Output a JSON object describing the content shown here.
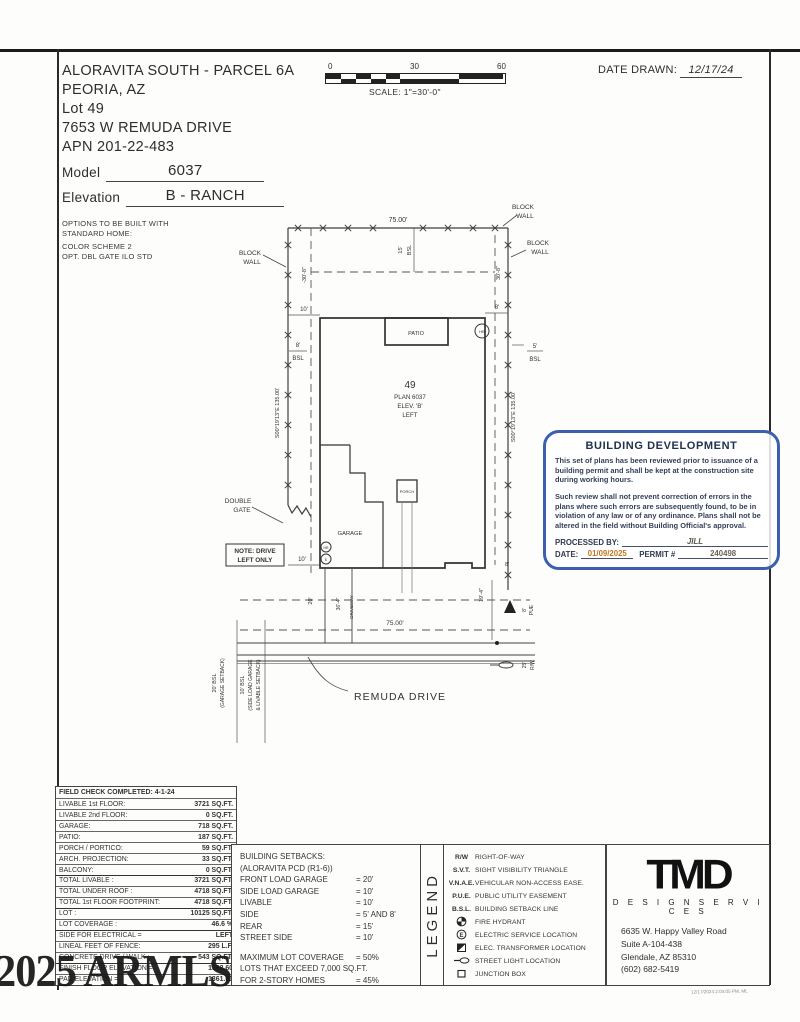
{
  "header": {
    "project": "ALORAVITA SOUTH - PARCEL 6A",
    "city": "PEORIA, AZ",
    "lot": "Lot  49",
    "address": "7653 W REMUDA DRIVE",
    "apn": "APN 201-22-483",
    "model_label": "Model",
    "model_value": "6037",
    "elevation_label": "Elevation",
    "elevation_value": "B - RANCH",
    "options_line1": "OPTIONS TO BE BUILT WITH",
    "options_line2": "STANDARD HOME:",
    "options_line3": "COLOR SCHEME 2",
    "options_line4": "OPT. DBL GATE ILO STD"
  },
  "scale_bar": {
    "tick0": "0",
    "tick30": "30",
    "tick60": "60",
    "scale_text": "SCALE:  1\"=30'-0\""
  },
  "date_drawn": {
    "label": "DATE DRAWN:",
    "value": "12/17/24"
  },
  "plan": {
    "labels": {
      "dim75_top": "75.00'",
      "dim75_bottom": "75.00'",
      "n15": "15'",
      "bsl": "BSL",
      "n30_8_neg": "-30'-8\"",
      "n30_8": "30'-8\"",
      "block": "BLOCK",
      "wall": "WALL",
      "n10": "10'",
      "n8": "8'",
      "n5": "5'",
      "patio": "PATIO",
      "hb": "HB",
      "e": "E",
      "lot49": "49",
      "plan_no": "PLAN 6037",
      "elev": "ELEV. 'B'",
      "left": "LEFT",
      "bearing": "S00°19'13\"E  135.00'",
      "double_word": "DOUBLE",
      "gate_word": "GATE",
      "garage": "GARAGE",
      "porch": "PORCH",
      "note1": "NOTE: DRIVE",
      "note2": "LEFT ONLY",
      "n20": "20'",
      "n36_4": "36'-4\"",
      "driveway": "DRIVEWAY",
      "n19_4": "19'-4\"",
      "pue": "PUE",
      "n25": "25'",
      "rw": "R/W",
      "street_name": "REMUDA DRIVE",
      "sb20a": "20' BSL",
      "sb20b": "(GARAGE SETBACK)",
      "sb10a": "10' BSL",
      "sb10b": "(SIDE LOAD GARAGE",
      "sb10c": "& LIVABLE SETBACK)"
    }
  },
  "stamp": {
    "title": "BUILDING DEVELOPMENT",
    "p1": "This set of plans has been reviewed prior to issuance of a building permit and shall be kept at the construction site during working hours.",
    "p2": "Such review shall not prevent correction of errors in the plans where such errors are subsequently found, to be in violation of any law or of any ordinance. Plans shall not be altered in the field without Building Official's approval.",
    "processed_label": "PROCESSED BY:",
    "processed_value": "JILL",
    "date_label": "DATE:",
    "date_value": "01/09/2025",
    "permit_label": "PERMIT #",
    "permit_value": "240498"
  },
  "site_table": {
    "title": "FIELD CHECK COMPLETED: 4-1-24",
    "rows": [
      {
        "label": "LIVABLE 1st FLOOR:",
        "value": "3721 SQ.FT."
      },
      {
        "label": "LIVABLE 2nd FLOOR:",
        "value": "0 SQ.FT."
      },
      {
        "label": "GARAGE:",
        "value": "718 SQ.FT."
      },
      {
        "label": "PATIO:",
        "value": "187 SQ.FT."
      },
      {
        "label": "PORCH / PORTICO:",
        "value": "59 SQ.FT."
      },
      {
        "label": "ARCH. PROJECTION:",
        "value": "33 SQ.FT."
      },
      {
        "label": "BALCONY:",
        "value": "0 SQ.FT."
      },
      {
        "label": "TOTAL LIVABLE :",
        "value": "3721 SQ.FT."
      },
      {
        "label": "TOTAL UNDER ROOF :",
        "value": "4718 SQ.FT."
      },
      {
        "label": "TOTAL 1st FLOOR FOOTPRINT:",
        "value": "4718 SQ.FT."
      },
      {
        "label": "LOT :",
        "value": "10125 SQ.FT."
      },
      {
        "label": "LOT COVERAGE :",
        "value": "46.6 %"
      },
      {
        "label": "SIDE FOR ELECTRICAL =",
        "value": "LEFT"
      },
      {
        "label": "LINEAL FEET OF FENCE:",
        "value": "295 L.F."
      },
      {
        "label": "CONCRETE DRIVE / WALK :",
        "value": "543 SQ.FT."
      },
      {
        "label": "FINISH FLOOR ELEVATION =",
        "value": "1362.60"
      },
      {
        "label": "PAD ELEVATION =",
        "value": "1361.60"
      }
    ]
  },
  "setbacks": {
    "title": "BUILDING SETBACKS:",
    "subtitle": "(ALORAVITA PCD (R1-6))",
    "rows": [
      {
        "label": "FRONT LOAD GARAGE",
        "value": "= 20'"
      },
      {
        "label": "SIDE LOAD GARAGE",
        "value": "= 10'"
      },
      {
        "label": "LIVABLE",
        "value": "= 10'"
      },
      {
        "label": "SIDE",
        "value": "= 5' AND 8'"
      },
      {
        "label": "REAR",
        "value": "= 15'"
      },
      {
        "label": "STREET SIDE",
        "value": "= 10'"
      }
    ],
    "max1_label": "MAXIMUM LOT COVERAGE",
    "max1_value": "= 50%",
    "max2": "LOTS THAT EXCEED 7,000 SQ.FT.",
    "max3_label": "FOR 2-STORY HOMES",
    "max3_value": "= 45%"
  },
  "legend": {
    "title": "LEGEND",
    "items": [
      {
        "symbol": "R/W",
        "desc": "RIGHT-OF-WAY"
      },
      {
        "symbol": "S.V.T.",
        "desc": "SIGHT VISIBILITY TRIANGLE"
      },
      {
        "symbol": "V.N.A.E.",
        "desc": "VEHICULAR NON-ACCESS EASE."
      },
      {
        "symbol": "P.U.E.",
        "desc": "PUBLIC UTILITY EASEMENT"
      },
      {
        "symbol": "B.S.L.",
        "desc": "BUILDING SETBACK LINE"
      },
      {
        "icon": "fire-hydrant",
        "desc": "FIRE HYDRANT"
      },
      {
        "icon": "electric-service",
        "icon_letter": "E",
        "desc": "ELECTRIC SERVICE LOCATION"
      },
      {
        "icon": "transformer",
        "desc": "ELEC. TRANSFORMER LOCATION"
      },
      {
        "icon": "street-light",
        "desc": "STREET LIGHT LOCATION"
      },
      {
        "icon": "junction-box",
        "desc": "JUNCTION BOX"
      }
    ]
  },
  "firm": {
    "logo": "TMD",
    "tagline": "D E S I G N   S E R V I C E S",
    "addr1": "6635 W. Happy Valley Road",
    "addr2": "Suite A-104-438",
    "addr3": "Glendale, AZ 85310",
    "phone": "(602) 682-5419"
  },
  "watermark": "2025 ARMLS",
  "scan_note": "12/17/2024 2:04:05 PM, ML"
}
